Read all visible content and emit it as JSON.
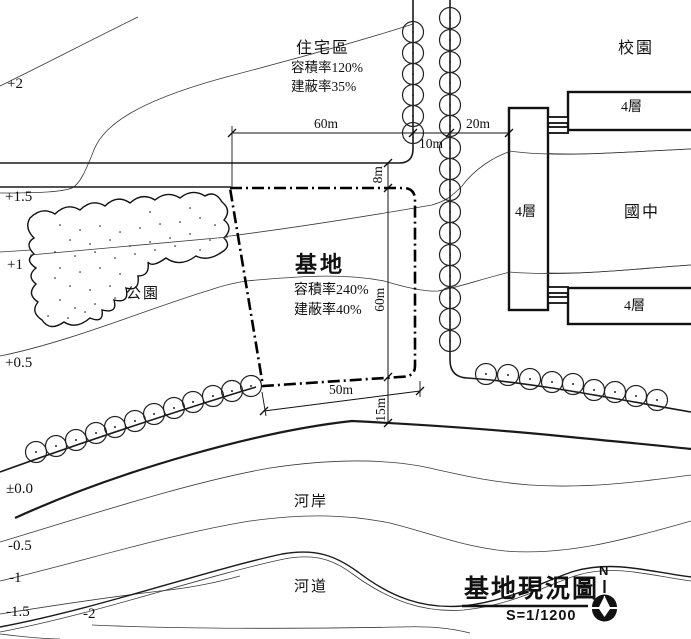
{
  "labels": {
    "residential": {
      "name": "住宅區",
      "far": "容積率120%",
      "coverage": "建蔽率35%"
    },
    "campus": {
      "name": "校園"
    },
    "school": {
      "name": "國中",
      "buildings": [
        {
          "label": "4層"
        },
        {
          "label": "4層"
        },
        {
          "label": "4層"
        }
      ]
    },
    "site": {
      "name": "基地",
      "far": "容積率240%",
      "coverage": "建蔽率40%"
    },
    "park": {
      "name": "公園"
    },
    "riverbank": {
      "name": "河岸"
    },
    "river_channel": {
      "name": "河道"
    }
  },
  "dimensions": {
    "top_width": "60m",
    "road_vertical_width": "10m",
    "school_offset": "20m",
    "road_horizontal_width": "8m",
    "site_depth": "60m",
    "site_width": "50m",
    "river_offset": "15m"
  },
  "elevations": [
    "+2",
    "+1.5",
    "+1",
    "+0.5",
    "±0.0",
    "-0.5",
    "-1",
    "-1.5",
    "-2"
  ],
  "title_block": {
    "title": "基地現況圖",
    "scale": "S=1/1200",
    "north": "N"
  },
  "style": {
    "line_color": "#1a1a1a",
    "contour_color": "#3a3a3a"
  }
}
